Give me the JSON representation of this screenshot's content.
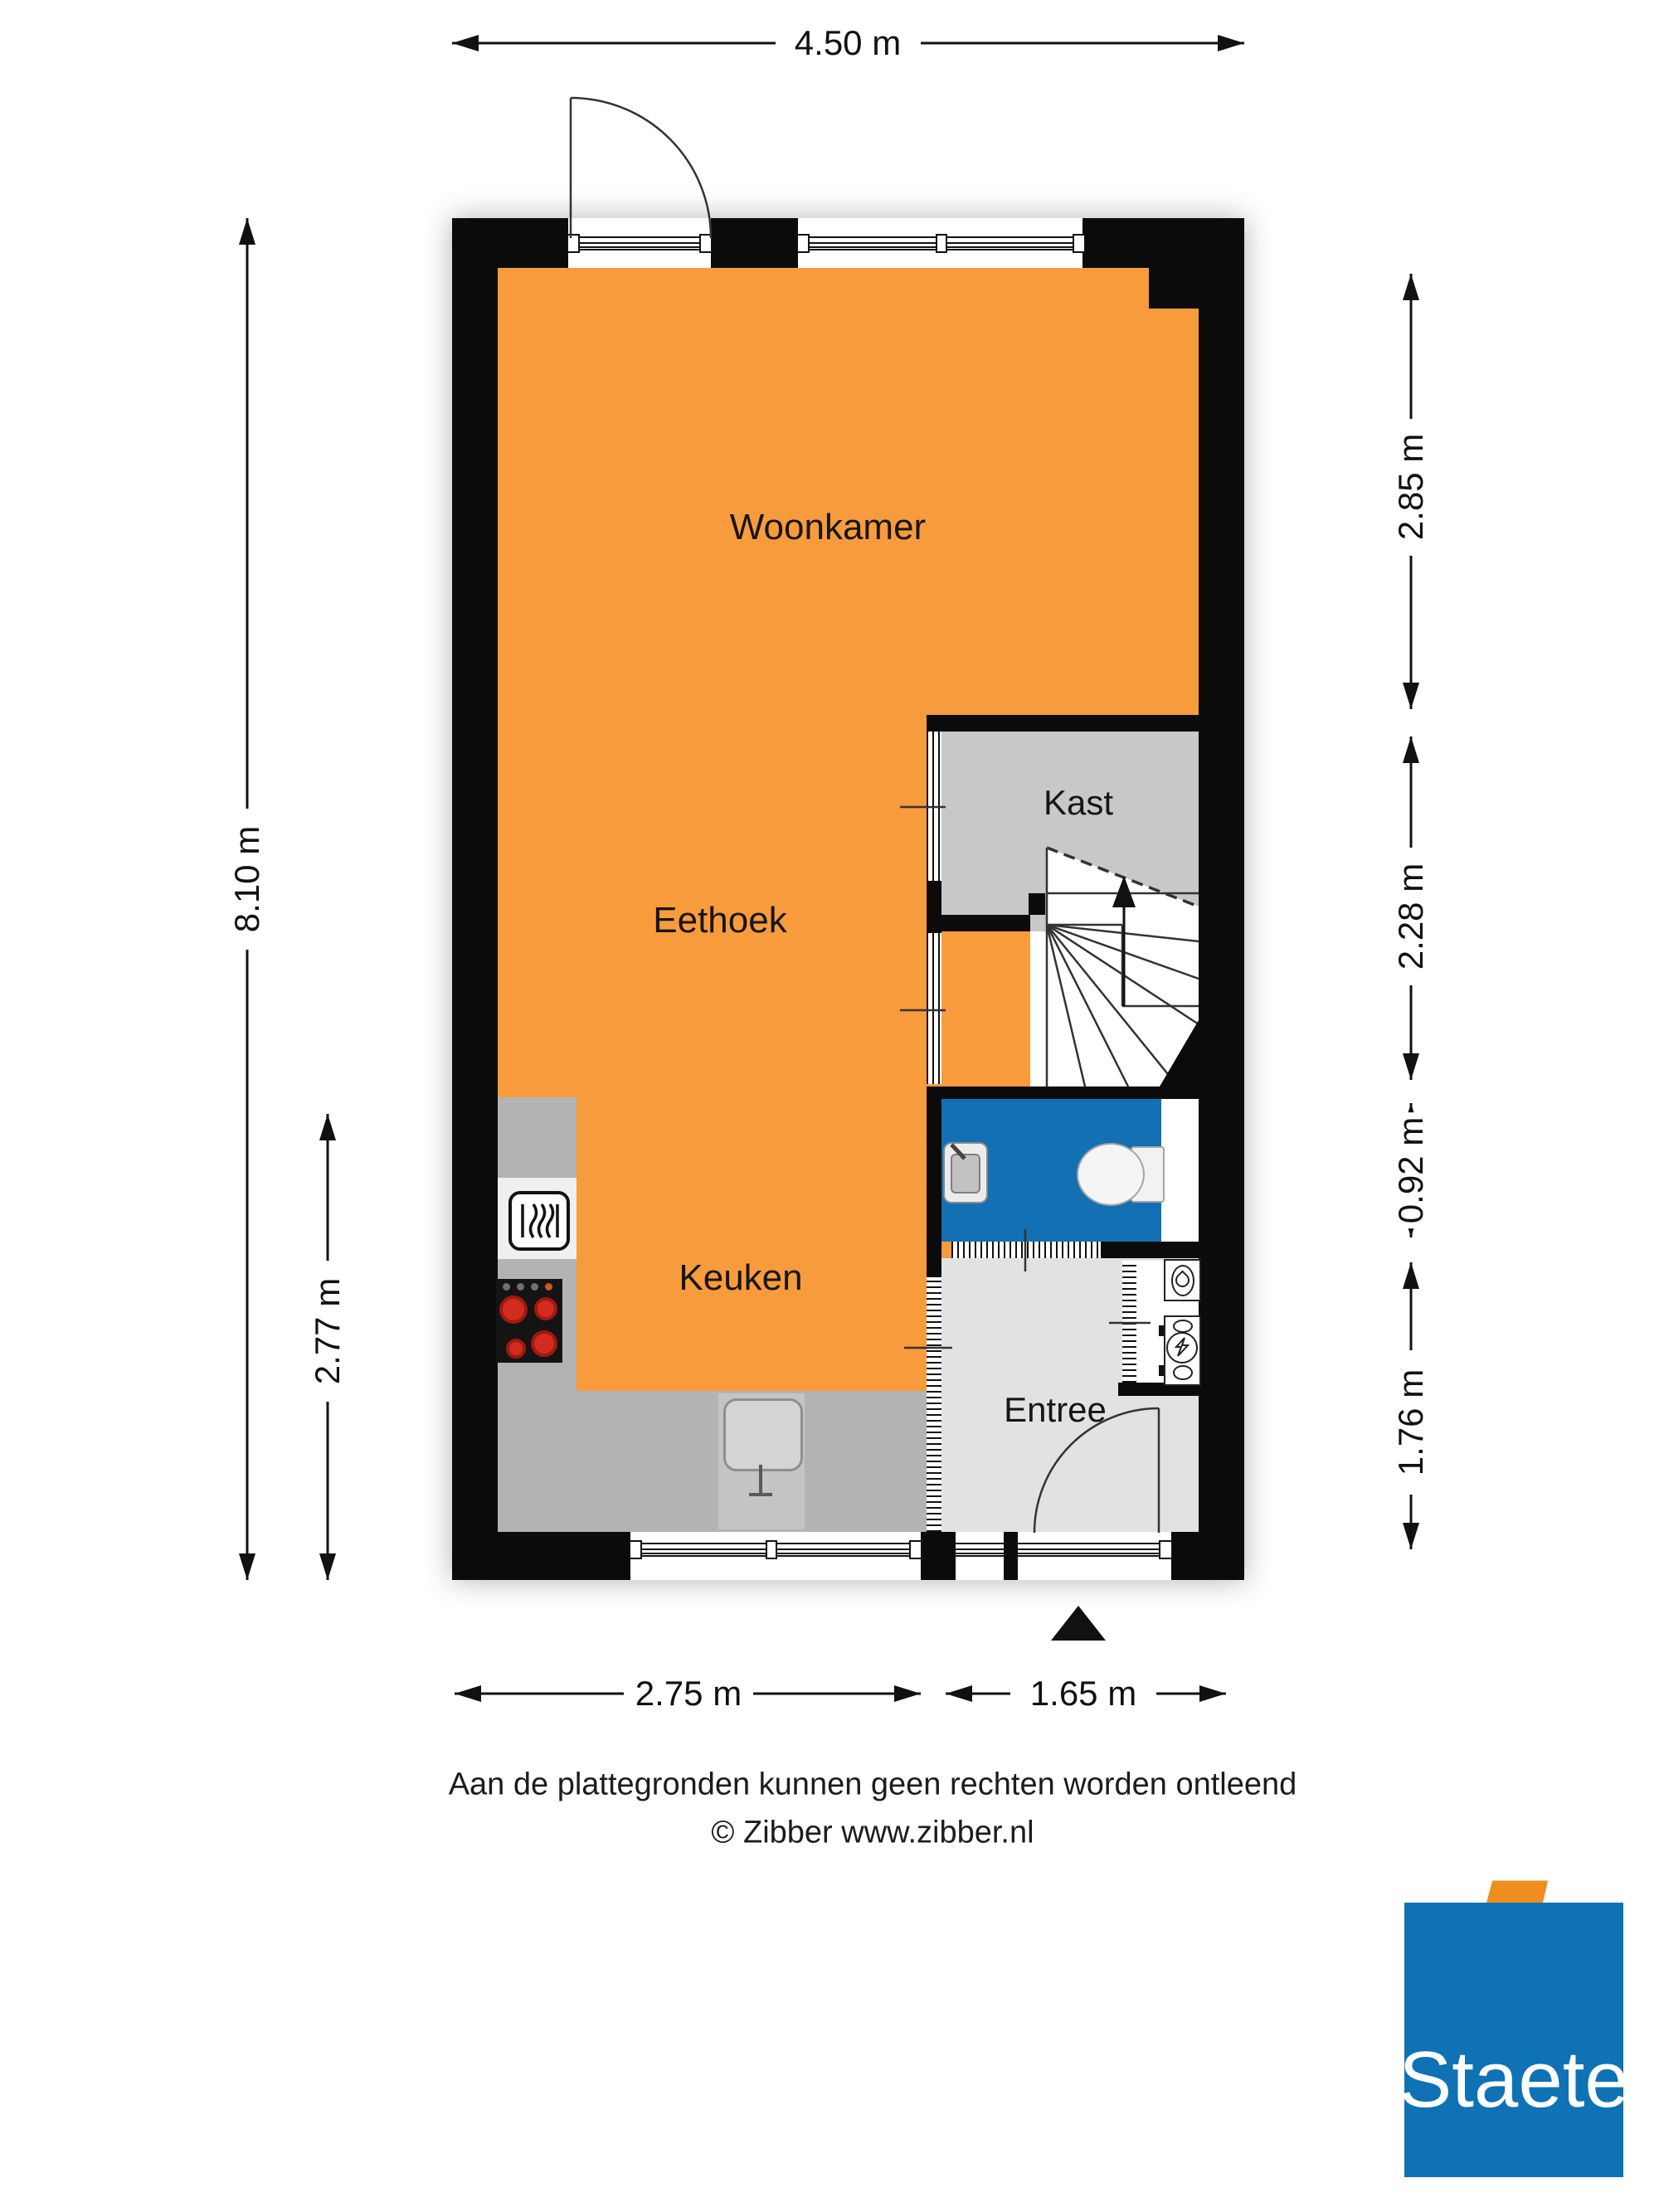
{
  "plan": {
    "rooms": {
      "woonkamer": "Woonkamer",
      "eethoek": "Eethoek",
      "keuken": "Keuken",
      "kast": "Kast",
      "entree": "Entree"
    },
    "dimensions": {
      "top_width": "4.50 m",
      "left_total_height": "8.10 m",
      "left_kitchen_height": "2.77 m",
      "right_living_depth": "2.85 m",
      "right_stairs_depth": "2.28 m",
      "right_toilet_depth": "0.92 m",
      "right_entree_depth": "1.76 m",
      "bottom_kitchen_width": "2.75 m",
      "bottom_entree_width": "1.65 m"
    },
    "icons": [
      "oven-icon",
      "cooktop-icon",
      "kitchen-sink-icon",
      "toilet-icon",
      "hand-basin-icon",
      "fountain-basin-icon",
      "boiler-icon",
      "stairs-up-arrow-icon",
      "entrance-triangle-icon"
    ],
    "colors": {
      "floor_orange": "#F89B3D",
      "toilet_blue": "#1371B3",
      "kast_gray": "#C8C8C8",
      "entree_gray": "#E2E2E2",
      "counter_gray": "#B3B3B3",
      "wall_black": "#0B0B0B",
      "logo_blue": "#0E72B5",
      "logo_orange": "#EF8D1E"
    }
  },
  "footer": {
    "disclaimer_line1": "Aan de plattegronden kunnen geen rechten worden ontleend",
    "disclaimer_line2": "© Zibber www.zibber.nl"
  },
  "logo": {
    "text": "Staete"
  }
}
